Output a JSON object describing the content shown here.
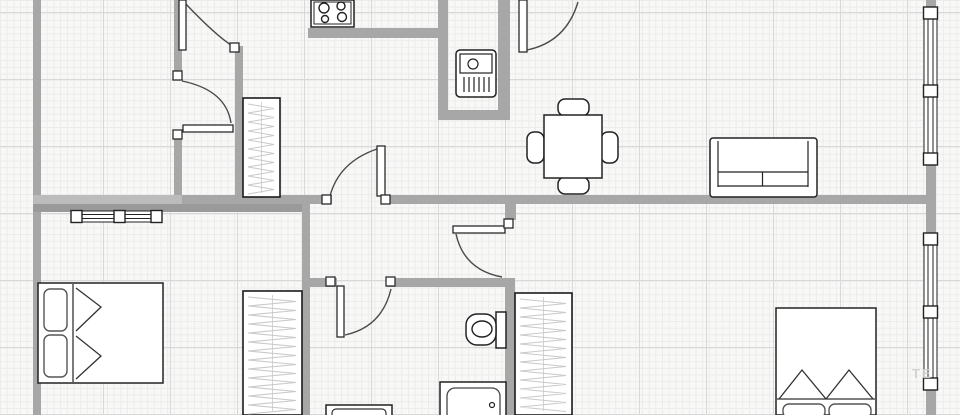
{
  "canvas": {
    "width": 960,
    "height": 415,
    "bg": "#f8f8f6",
    "grid_minor": "#ececec",
    "grid_major": "#d8d8d8",
    "wall_color": "#a7a7a7",
    "wall_color_light": "#bcbcbc",
    "wall_color_dark": "#9a9a9a",
    "outline_color": "#222222",
    "door_arc_color": "#4a4a4a",
    "hatch_color": "#c9c9c9",
    "fixture_fill": "#ffffff"
  },
  "walls": [
    {
      "name": "outer-left",
      "x": 33,
      "y": 0,
      "w": 8,
      "h": 415,
      "shade": "main"
    },
    {
      "name": "upper-hall-left-a",
      "x": 174,
      "y": 0,
      "w": 8,
      "h": 72,
      "shade": "main"
    },
    {
      "name": "upper-hall-left-b",
      "x": 174,
      "y": 139,
      "w": 8,
      "h": 65,
      "shade": "main"
    },
    {
      "name": "upper-hall-right",
      "x": 235,
      "y": 46,
      "w": 8,
      "h": 158,
      "shade": "main"
    },
    {
      "name": "kitchen-alcove",
      "x": 308,
      "y": 28,
      "w": 130,
      "h": 10,
      "shade": "main"
    },
    {
      "name": "boiler-niche-left",
      "x": 438,
      "y": 0,
      "w": 10,
      "h": 120,
      "shade": "main"
    },
    {
      "name": "boiler-niche-right",
      "x": 498,
      "y": 0,
      "w": 12,
      "h": 120,
      "shade": "main"
    },
    {
      "name": "boiler-niche-bottom",
      "x": 438,
      "y": 110,
      "w": 72,
      "h": 10,
      "shade": "main"
    },
    {
      "name": "main-horiz-left",
      "x": 33,
      "y": 195,
      "w": 149,
      "h": 9,
      "shade": "light"
    },
    {
      "name": "main-horiz-mid",
      "x": 182,
      "y": 195,
      "w": 150,
      "h": 9,
      "shade": "main"
    },
    {
      "name": "main-horiz-right",
      "x": 382,
      "y": 195,
      "w": 554,
      "h": 9,
      "shade": "main"
    },
    {
      "name": "bedroom1-top",
      "x": 33,
      "y": 204,
      "w": 277,
      "h": 8,
      "shade": "dark"
    },
    {
      "name": "bedroom1-right",
      "x": 302,
      "y": 204,
      "w": 8,
      "h": 211,
      "shade": "main"
    },
    {
      "name": "corridor-door-stub",
      "x": 505,
      "y": 204,
      "w": 11,
      "h": 16,
      "shade": "main"
    },
    {
      "name": "bathroom-right",
      "x": 505,
      "y": 278,
      "w": 10,
      "h": 137,
      "shade": "main"
    },
    {
      "name": "hall2-top-left",
      "x": 310,
      "y": 278,
      "w": 27,
      "h": 9,
      "shade": "main"
    },
    {
      "name": "hall2-top-right",
      "x": 387,
      "y": 278,
      "w": 123,
      "h": 9,
      "shade": "main"
    },
    {
      "name": "outer-right",
      "x": 926,
      "y": 0,
      "w": 10,
      "h": 415,
      "shade": "main"
    }
  ],
  "doors": [
    {
      "name": "door-closet-top",
      "leaf": {
        "x": 179,
        "y": 0,
        "w": 7,
        "h": 50
      },
      "arc": "M 184 2 Q 216 36 234 47",
      "hinges": [
        {
          "x": 230,
          "y": 43
        }
      ]
    },
    {
      "name": "door-closet-mid",
      "leaf": {
        "x": 183,
        "y": 125,
        "w": 50,
        "h": 7
      },
      "arc": "M 182 81 Q 226 90 231 123",
      "hinges": [
        {
          "x": 173,
          "y": 71
        },
        {
          "x": 173,
          "y": 130
        }
      ]
    },
    {
      "name": "door-kitchen-top",
      "leaf": {
        "x": 519,
        "y": 0,
        "w": 8,
        "h": 52
      },
      "arc": "M 527 50 Q 566 42 578 2",
      "hinges": []
    },
    {
      "name": "door-living-hall",
      "leaf": {
        "x": 377,
        "y": 146,
        "w": 8,
        "h": 50
      },
      "arc": "M 330 196 Q 339 162 377 149",
      "hinges": [
        {
          "x": 322,
          "y": 195
        },
        {
          "x": 381,
          "y": 195
        }
      ]
    },
    {
      "name": "door-corridor-east",
      "leaf": {
        "x": 453,
        "y": 226,
        "w": 52,
        "h": 7
      },
      "arc": "M 456 234 Q 464 270 502 277",
      "hinges": [
        {
          "x": 504,
          "y": 219
        }
      ]
    },
    {
      "name": "door-hall-south",
      "leaf": {
        "x": 337,
        "y": 286,
        "w": 7,
        "h": 51
      },
      "arc": "M 345 335 Q 382 327 391 289",
      "hinges": [
        {
          "x": 326,
          "y": 277
        },
        {
          "x": 386,
          "y": 277
        }
      ]
    }
  ],
  "windows": [
    {
      "name": "window-bedroom1",
      "orient": "h",
      "x": 71,
      "y": 211,
      "length": 91,
      "thickness": 11,
      "squares": [
        0,
        43,
        80
      ]
    },
    {
      "name": "window-right-top",
      "orient": "v",
      "x": 924,
      "y": 7,
      "length": 157,
      "thickness": 13,
      "squares": [
        0,
        78,
        146
      ]
    },
    {
      "name": "window-right-bottom",
      "orient": "v",
      "x": 924,
      "y": 233,
      "length": 157,
      "thickness": 13,
      "squares": [
        0,
        73,
        145
      ]
    }
  ],
  "furniture": [
    {
      "name": "stove-cooktop",
      "type": "stove",
      "x": 311,
      "y": 0,
      "w": 43,
      "h": 27,
      "burners": [
        [
          324,
          8,
          5
        ],
        [
          341,
          6,
          4
        ],
        [
          325,
          19,
          3.5
        ],
        [
          342,
          17,
          4.5
        ]
      ]
    },
    {
      "name": "boiler",
      "type": "boiler",
      "x": 456,
      "y": 50,
      "w": 40,
      "h": 47
    },
    {
      "name": "wardrobe-kitchen",
      "type": "wardrobe",
      "x": 243,
      "y": 98,
      "w": 37,
      "h": 99
    },
    {
      "name": "wardrobe-bedroom1",
      "type": "wardrobe",
      "x": 243,
      "y": 291,
      "w": 59,
      "h": 124
    },
    {
      "name": "wardrobe-bedroom2",
      "type": "wardrobe",
      "x": 515,
      "y": 293,
      "w": 57,
      "h": 122
    },
    {
      "name": "dining-table-set",
      "type": "table_set",
      "table": {
        "x": 544,
        "y": 115,
        "w": 58,
        "h": 63
      },
      "chairs": [
        {
          "x": 558,
          "y": 99,
          "w": 31,
          "h": 17
        },
        {
          "x": 558,
          "y": 177,
          "w": 31,
          "h": 17
        },
        {
          "x": 527,
          "y": 132,
          "w": 17,
          "h": 31
        },
        {
          "x": 601,
          "y": 132,
          "w": 17,
          "h": 31
        }
      ]
    },
    {
      "name": "sofa",
      "type": "sofa",
      "x": 710,
      "y": 138,
      "w": 107,
      "h": 59
    },
    {
      "name": "bed-bedroom1",
      "type": "bed",
      "x": 38,
      "y": 283,
      "w": 125,
      "h": 100,
      "pillows": [
        {
          "x": 44,
          "y": 289,
          "w": 23,
          "h": 42
        },
        {
          "x": 44,
          "y": 335,
          "w": 23,
          "h": 42
        }
      ],
      "lines": [
        "M 73 284 L 73 382",
        "M 76 288 L 101 307 L 76 331",
        "M 76 336 L 101 356 L 76 379"
      ]
    },
    {
      "name": "bed-bedroom2",
      "type": "bed",
      "x": 776,
      "y": 308,
      "w": 100,
      "h": 107,
      "pillows": [
        {
          "x": 783,
          "y": 404,
          "w": 42,
          "h": 14
        },
        {
          "x": 829,
          "y": 404,
          "w": 42,
          "h": 14
        }
      ],
      "lines": [
        "M 777 399 L 875 399",
        "M 779 399 L 802 370 L 826 399",
        "M 826 399 L 849 370 L 873 399"
      ]
    },
    {
      "name": "toilet",
      "type": "toilet",
      "tank": {
        "x": 496,
        "y": 312,
        "w": 10,
        "h": 36
      },
      "bowl": {
        "x": 466,
        "y": 314,
        "w": 30,
        "h": 31
      },
      "ellipse": {
        "cx": 482,
        "cy": 329,
        "rx": 10,
        "ry": 8
      }
    },
    {
      "name": "bathtub",
      "type": "bathtub",
      "outer": {
        "x": 440,
        "y": 382,
        "w": 66,
        "h": 33
      },
      "inner": {
        "x": 447,
        "y": 388,
        "w": 53,
        "h": 34
      },
      "drain": {
        "cx": 492,
        "cy": 405,
        "r": 2.5
      }
    },
    {
      "name": "dresser-hall",
      "type": "dresser",
      "outer": {
        "x": 326,
        "y": 405,
        "w": 66,
        "h": 14
      },
      "inner": {
        "x": 332,
        "y": 409,
        "w": 54,
        "h": 12
      }
    }
  ],
  "watermark": {
    "text": "TE",
    "x": 912,
    "y": 378
  }
}
